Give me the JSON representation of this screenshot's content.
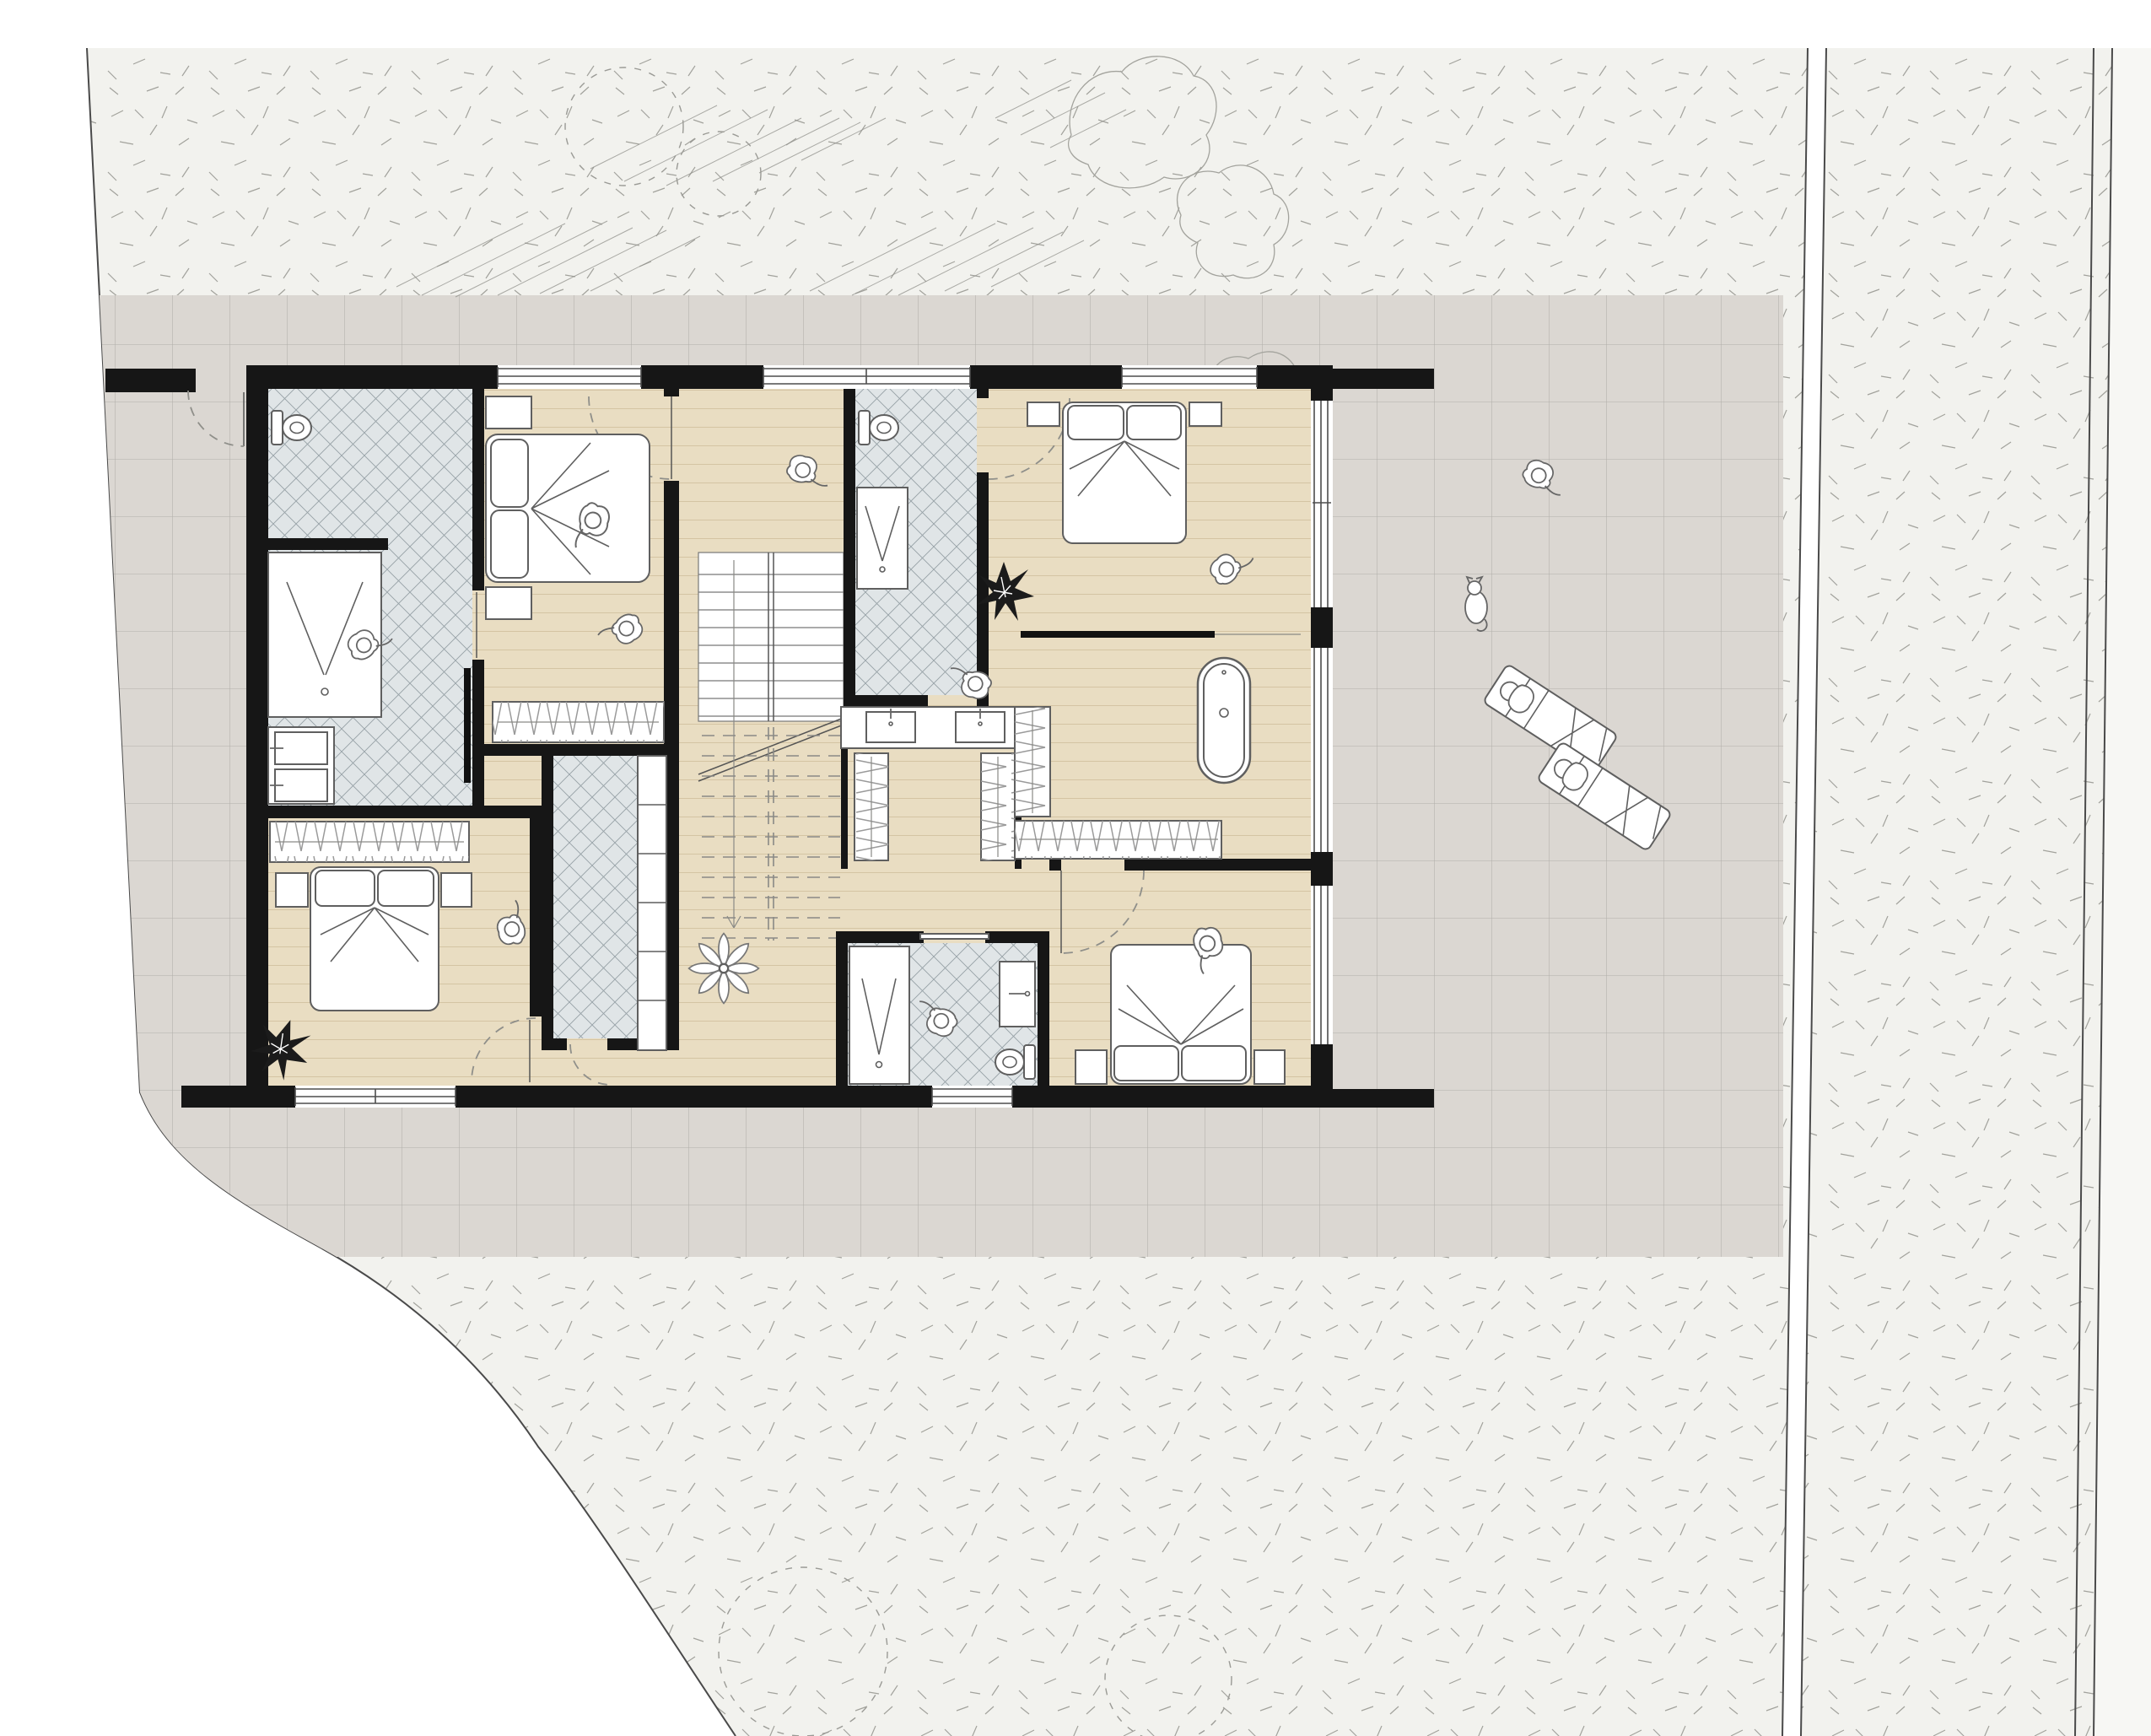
{
  "document": {
    "type": "architectural-floor-plan",
    "view": "top-down-plan",
    "level": "bedroom-floor-with-site",
    "visible_text": "none"
  },
  "colors": {
    "background": "#ffffff",
    "lawn": "#f2f2ee",
    "lawn_stipple": "#a2a29c",
    "terrace_tile": "#dbd7d2",
    "tile_joint": "#b2afaa",
    "wood": "#e9ddc2",
    "wood_line": "#bfab84",
    "bath_tile": "#e0e5e7",
    "bath_hatch": "#96a1a6",
    "wall": "#161616",
    "outline": "#5f5f5f",
    "road_line": "#4a4a4a",
    "pavement": "#f7f7f4"
  },
  "site": {
    "areas": [
      "lawn-with-stipple-texture",
      "paved-terrace-tile-grid",
      "road-verge-and-road",
      "curved-plot-boundary"
    ],
    "landscape": [
      "tree-canopy-hatching",
      "bush-outlines",
      "dashed-tree-circles"
    ],
    "figures": {
      "people": 12,
      "cats": 1,
      "sun_loungers": 2,
      "plants_dark": 2,
      "plant_white_flower": 1
    }
  },
  "rooms": [
    {
      "name": "ensuite-bathroom-top-left",
      "floor": "crosshatch-tile",
      "fixtures": [
        "toilet",
        "shower",
        "double-basin-vanity",
        "towel-radiator"
      ]
    },
    {
      "name": "bedroom-top-left",
      "floor": "wood-planks",
      "fixtures": [
        "double-bed",
        "nightstand",
        "nightstand",
        "wardrobe"
      ]
    },
    {
      "name": "hall-staircase",
      "floor": "wood-planks",
      "fixtures": [
        "u-shaped-stair",
        "flower-plant"
      ]
    },
    {
      "name": "bathroom-top-middle",
      "floor": "crosshatch-tile",
      "fixtures": [
        "toilet",
        "shower",
        "sliding-door"
      ]
    },
    {
      "name": "master-suite-top-right",
      "floor": "wood-planks",
      "fixtures": [
        "double-bed",
        "nightstand",
        "nightstand",
        "freestanding-bathtub",
        "double-sink-island",
        "walk-in-wardrobes",
        "curtain-rail",
        "plant"
      ]
    },
    {
      "name": "utility-closet-middle",
      "floor": "crosshatch-tile",
      "fixtures": [
        "shelving-column"
      ]
    },
    {
      "name": "bedroom-bottom-left",
      "floor": "wood-planks",
      "fixtures": [
        "double-bed",
        "nightstand",
        "nightstand",
        "wardrobe",
        "plant"
      ]
    },
    {
      "name": "bathroom-bottom-middle",
      "floor": "crosshatch-tile",
      "fixtures": [
        "shower",
        "vanity",
        "toilet",
        "sliding-door"
      ]
    },
    {
      "name": "bedroom-bottom-right",
      "floor": "wood-planks",
      "fixtures": [
        "double-bed",
        "nightstand",
        "nightstand"
      ]
    }
  ],
  "openings": {
    "top_windows": 3,
    "bottom_windows": 2,
    "right_glazing_panels": 3,
    "garden_gate_with_swing": 1,
    "interior_door_swings": 5
  }
}
